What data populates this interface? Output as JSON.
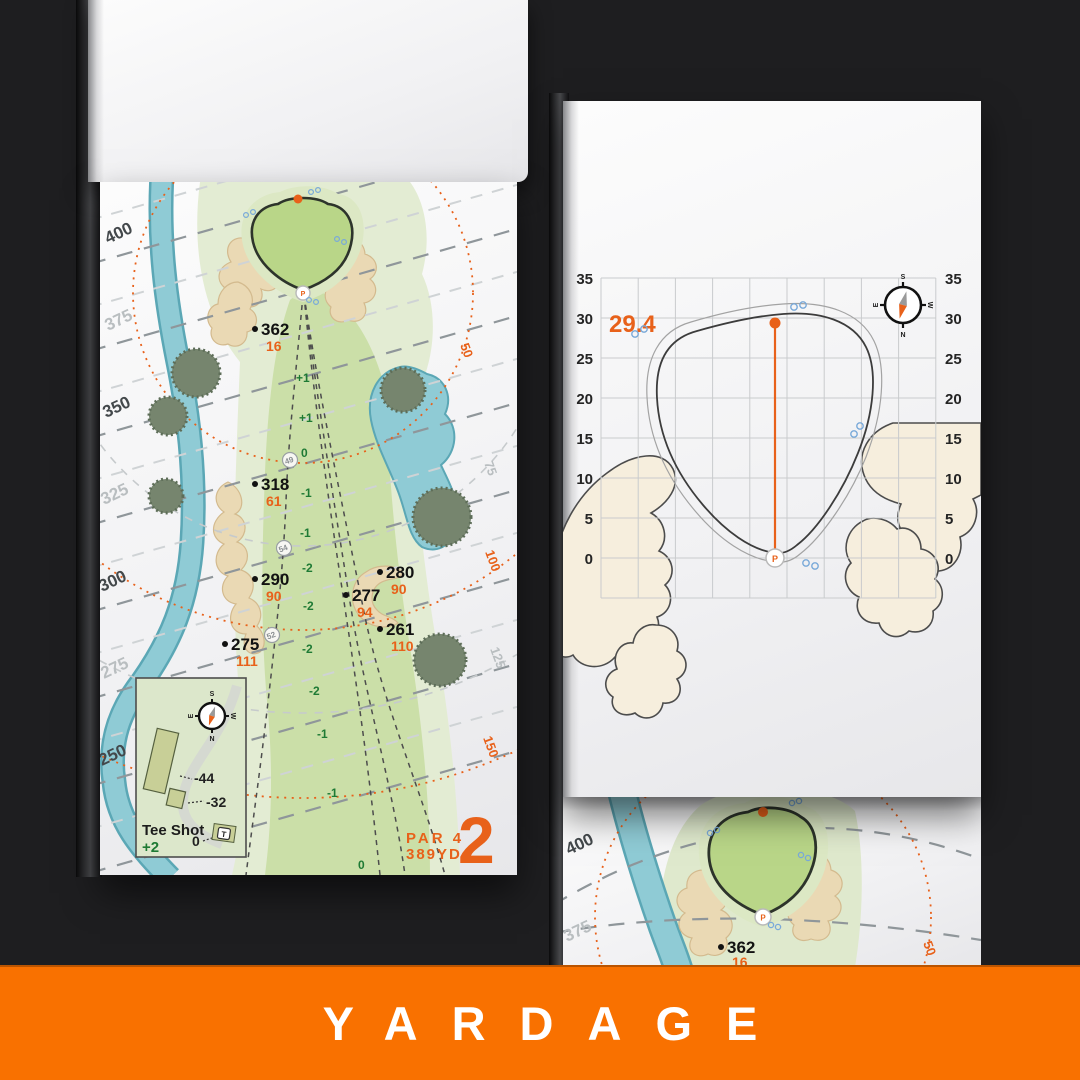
{
  "banner": {
    "label": "YARDAGE",
    "bg": "#f97100"
  },
  "compass": {
    "n": "N",
    "s": "S",
    "e": "E",
    "w": "W"
  },
  "symbols": {
    "pin": "P"
  },
  "left_page": {
    "hole": {
      "number": "2",
      "par": "PAR 4",
      "yards": "389YD"
    },
    "tee_lines": [
      {
        "label": "400"
      },
      {
        "label": "375"
      },
      {
        "label": "350"
      },
      {
        "label": "325"
      },
      {
        "label": "300"
      },
      {
        "label": "275"
      },
      {
        "label": "250"
      }
    ],
    "arc_labels": [
      {
        "label": "50"
      },
      {
        "label": "75"
      },
      {
        "label": "100"
      },
      {
        "label": "125"
      },
      {
        "label": "150"
      }
    ],
    "markers": [
      {
        "yards": "362",
        "alt": "16"
      },
      {
        "yards": "318",
        "alt": "61"
      },
      {
        "yards": "290",
        "alt": "90"
      },
      {
        "yards": "275",
        "alt": "111"
      },
      {
        "yards": "280",
        "alt": "90"
      },
      {
        "yards": "277",
        "alt": "94"
      },
      {
        "yards": "261",
        "alt": "110"
      }
    ],
    "waypoints": [
      {
        "label": "49"
      },
      {
        "label": "54"
      },
      {
        "label": "52"
      }
    ],
    "elevations": [
      {
        "label": "+1"
      },
      {
        "label": "+1"
      },
      {
        "label": "0"
      },
      {
        "label": "-1"
      },
      {
        "label": "-1"
      },
      {
        "label": "-2"
      },
      {
        "label": "-2"
      },
      {
        "label": "-2"
      },
      {
        "label": "-2"
      },
      {
        "label": "-1"
      },
      {
        "label": "-1"
      },
      {
        "label": "0"
      }
    ],
    "inset": {
      "title": "Tee Shot",
      "score": "+2",
      "dist_long": "-44",
      "dist_short": "-32",
      "dist_zero": "0",
      "tee": "T"
    }
  },
  "right_page": {
    "depth": "29.4",
    "y_ticks": [
      {
        "label": "35"
      },
      {
        "label": "30"
      },
      {
        "label": "25"
      },
      {
        "label": "20"
      },
      {
        "label": "15"
      },
      {
        "label": "10"
      },
      {
        "label": "5"
      },
      {
        "label": "0"
      }
    ],
    "axis_range": {
      "min": 0,
      "max": 35,
      "step": 5
    },
    "green_depth_yards": 29.4
  },
  "bottom_page": {
    "tee_lines": [
      {
        "label": "400"
      },
      {
        "label": "375"
      }
    ],
    "marker": {
      "yards": "362",
      "alt": "16"
    },
    "arc_label": "50"
  }
}
